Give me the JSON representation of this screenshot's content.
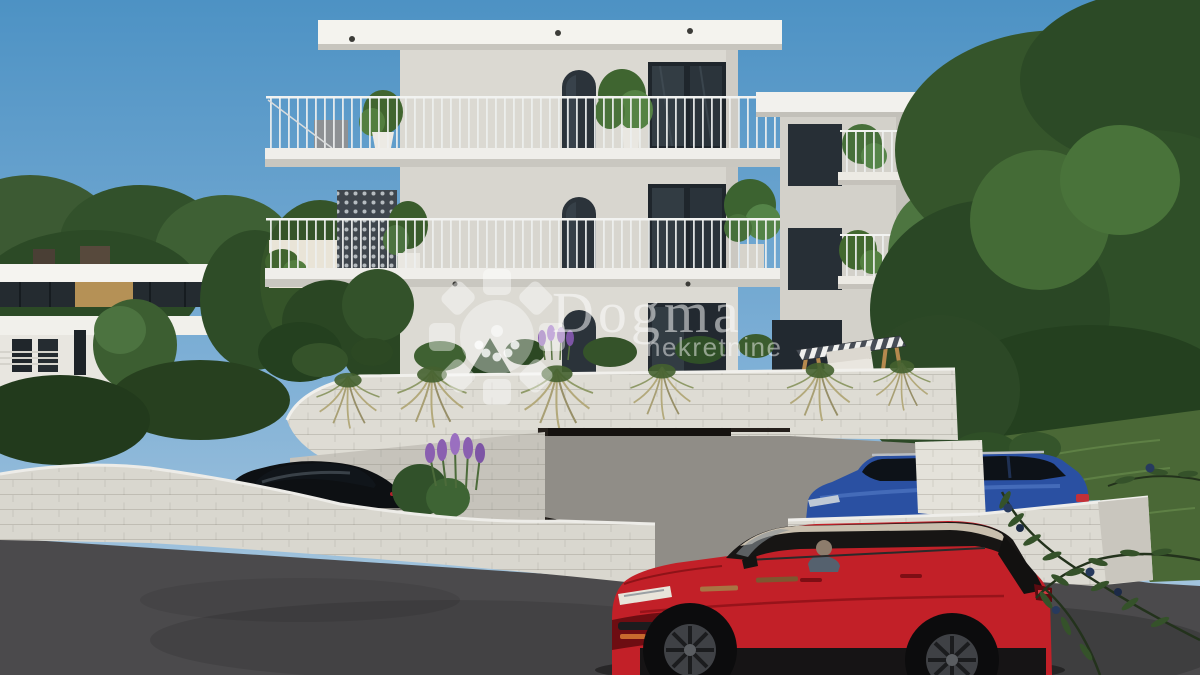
{
  "watermark": {
    "brand": "Dogma",
    "subtitle": "nekretnine",
    "logo": "pinwheel-sun-icon",
    "color": "rgba(255,255,255,0.52)"
  },
  "scene": {
    "type": "3D exterior architectural rendering",
    "subject": "Modern three-story apartment building with balconies, arched windows, stone retaining walls, garage and driveway",
    "sky": "clear blue daytime sky",
    "left_background": "neighboring modern flat-roof villa among trees",
    "right_background": "dense green trees partially hiding another white building",
    "foreground": "asphalt street with red SUV driving past; olive branch at bottom right"
  },
  "main_building": {
    "floors": 3,
    "features": [
      "flat roof with deep overhang and downlights",
      "arched windows",
      "glass sliding doors",
      "balconies with thin metal railings",
      "potted plants on balconies",
      "perforated privacy screen",
      "curved terrace planter wall with ornamental grasses",
      "wooden swing bench with striped canopy",
      "bronze sectional garage door with 3 windows"
    ]
  },
  "vehicles": [
    {
      "name": "black-sedan",
      "position": "parked behind left stone wall"
    },
    {
      "name": "blue-estate-suv",
      "position": "parked behind right stone wall"
    },
    {
      "name": "red-suv",
      "position": "driving on street in foreground, driver visible"
    }
  ],
  "colors": {
    "sky_top": "#4d92c4",
    "sky_horizon": "#a6c6de",
    "wall": "#dad8d1",
    "roof": "#f4f3ee",
    "glass": "#272f36",
    "stone": "#dcdad2",
    "asphalt": "#4b4a4c",
    "driveway": "#908d87",
    "foliage": "#35532a",
    "grass": "#4a6836",
    "garage_door": "#6e5d4a",
    "railing": "#eef0ef",
    "car_red": "#c22028",
    "car_blue": "#2a50a2",
    "car_black": "#0d1013",
    "lavender": "#8a5fb0",
    "swing_wood": "#b5894e"
  }
}
